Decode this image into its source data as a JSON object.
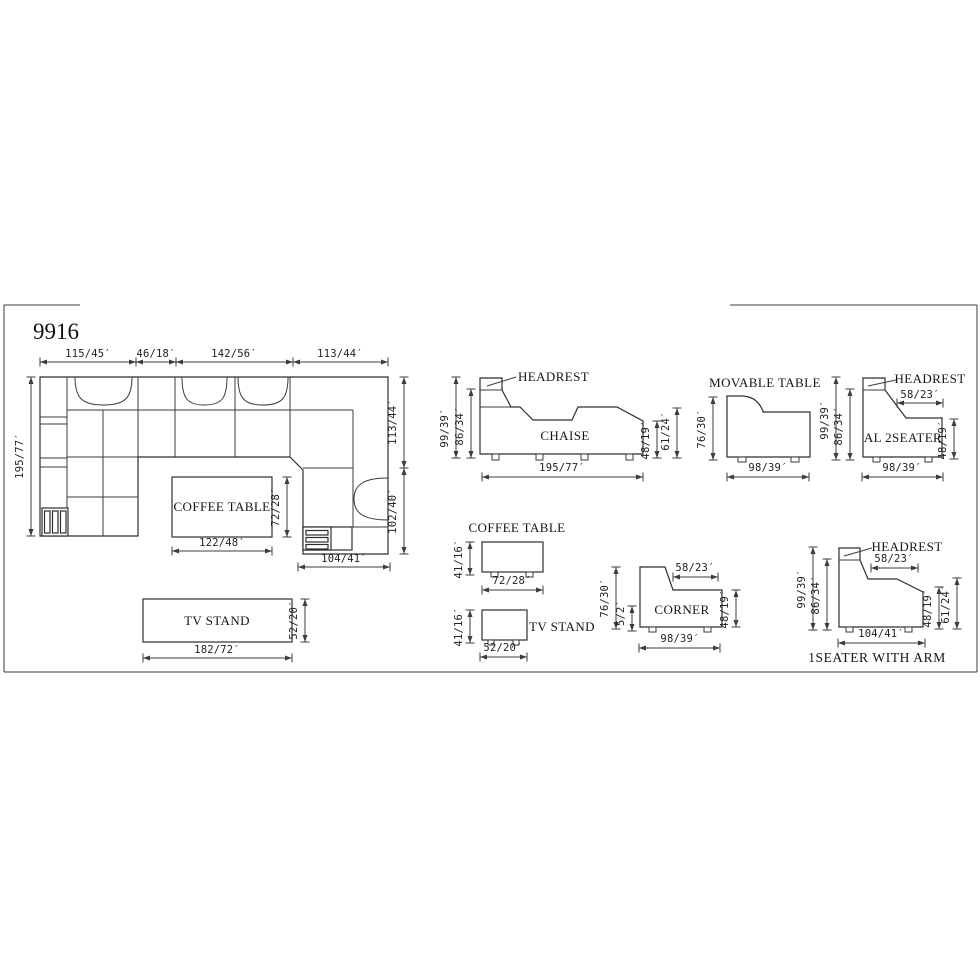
{
  "title": "9916",
  "plan": {
    "top_dims": [
      "115/45′",
      "46/18′",
      "142/56′",
      "113/44′"
    ],
    "left_dim": "195/77′",
    "right_dim_upper": "113/44′",
    "right_dim_lower": "102/40′",
    "bottom_right_dim": "104/41′",
    "coffee_table": {
      "label": "COFFEE TABLE",
      "width_dim": "122/48′",
      "depth_dim": "72/28′"
    },
    "tv_stand": {
      "label": "TV STAND",
      "width_dim": "182/72′",
      "depth_dim": "52/20′"
    }
  },
  "views": {
    "chaise": {
      "label": "CHAISE",
      "headrest_label": "HEADREST",
      "total_height_dim": "99/39′",
      "back_height_dim": "86/34′",
      "seat_height_dim": "48/19′",
      "arm_height_dim": "61/24′",
      "length_dim": "195/77′"
    },
    "movable_table": {
      "label": "MOVABLE TABLE",
      "height_dim": "76/30′",
      "width_dim": "98/39′"
    },
    "al_2seater": {
      "label": "AL 2SEATER",
      "headrest_label": "HEADREST",
      "total_height_dim": "99/39′",
      "back_height_dim": "86/34′",
      "back_depth_dim": "58/23′",
      "seat_height_dim": "48/19′",
      "width_dim": "98/39′"
    },
    "coffee_table": {
      "label": "COFFEE TABLE",
      "height_dim": "41/16′",
      "width_dim": "72/28′"
    },
    "tv_stand": {
      "label": "TV STAND",
      "height_dim": "41/16′",
      "width_dim": "52/20′"
    },
    "corner": {
      "label": "CORNER",
      "height_dim": "76/30′",
      "base_clearance_dim": "5/2′",
      "back_depth_dim": "58/23′",
      "seat_height_dim": "48/19′",
      "width_dim": "98/39′"
    },
    "one_seater_with_arm": {
      "label": "1SEATER WITH ARM",
      "headrest_label": "HEADREST",
      "total_height_dim": "99/39′",
      "back_height_dim": "86/34′",
      "back_depth_dim": "58/23′",
      "seat_height_dim": "48/19′",
      "arm_height_dim": "61/24′",
      "width_dim": "104/41′"
    }
  },
  "colors": {
    "line": "#3b3b3b",
    "text": "#151515",
    "background": "#ffffff"
  }
}
